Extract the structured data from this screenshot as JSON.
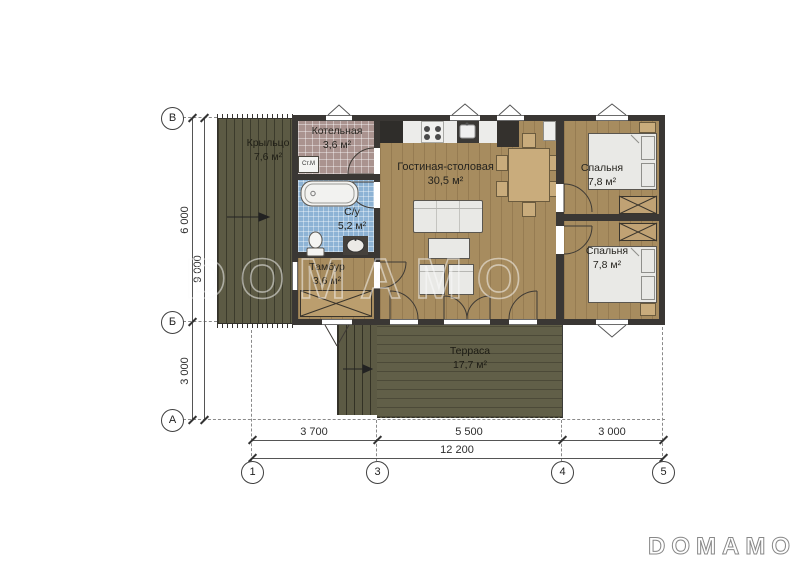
{
  "watermark": {
    "text": "DOMAMO"
  },
  "brand_logo": {
    "text": "DOMAMO"
  },
  "rooms": [
    {
      "id": "porch",
      "name": "Крыльцо",
      "area": "7,6 м²"
    },
    {
      "id": "boiler",
      "name": "Котельная",
      "area": "3,6 м²"
    },
    {
      "id": "bathroom",
      "name": "С/у",
      "area": "5,2 м²"
    },
    {
      "id": "tambour",
      "name": "Тамбур",
      "area": "3,6 м²"
    },
    {
      "id": "living",
      "name": "Гостиная-столовая",
      "area": "30,5 м²"
    },
    {
      "id": "bedroom1",
      "name": "Спальня",
      "area": "7,8 м²"
    },
    {
      "id": "bedroom2",
      "name": "Спальня",
      "area": "7,8 м²"
    },
    {
      "id": "terrace",
      "name": "Терраса",
      "area": "17,7 м²"
    }
  ],
  "appliances": {
    "washing_machine": "Ст.М"
  },
  "axes": {
    "left": [
      "В",
      "Б",
      "А"
    ],
    "bottom": [
      "1",
      "3",
      "4",
      "5"
    ]
  },
  "dimensions": {
    "left": {
      "segments": [
        "6 000",
        "3 000"
      ],
      "total": "9 000"
    },
    "bottom": {
      "segments": [
        "3 700",
        "5 500",
        "3 000"
      ],
      "total": "12 200"
    }
  },
  "palette": {
    "wall": "#3a3734",
    "wood_floor": "#a78c5f",
    "deck": "#5c5a44",
    "terrace": "#615f48",
    "boiler_tile": "#aa938f",
    "bath_tile": "#8db3d5",
    "furniture_light": "#e9e9e6",
    "furniture_tan": "#c9ac7c"
  }
}
